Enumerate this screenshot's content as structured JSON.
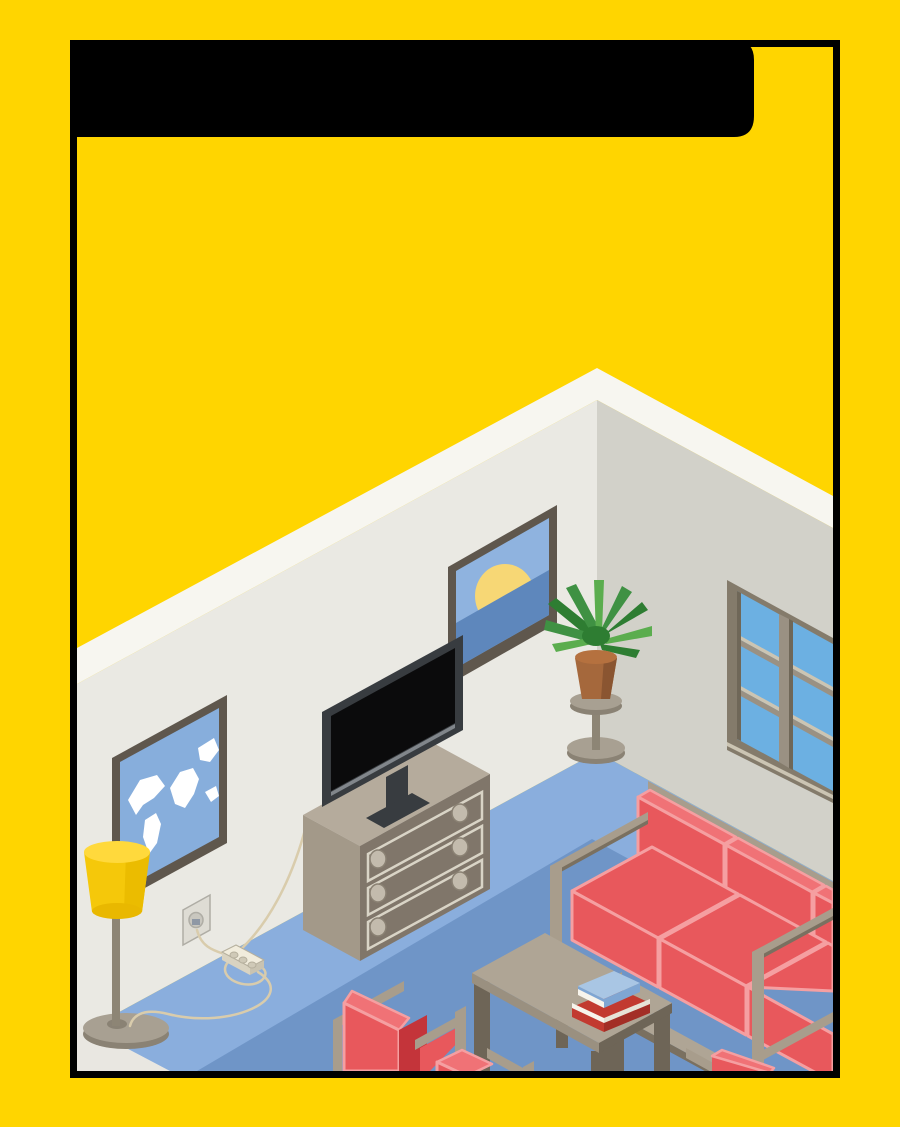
{
  "scene": {
    "description": "Isometric living-room illustration inside a black rectangular frame on a yellow poster; blank black rounded banner at top",
    "objects": [
      "title-banner",
      "poster-frame",
      "room-corner-walls",
      "blue-carpet",
      "dark-blue-rug",
      "world-map-picture",
      "sunset-picture",
      "window",
      "tv",
      "drawer-dresser",
      "floor-lamp",
      "plant-stand",
      "potted-plant",
      "wall-outlet",
      "power-strip",
      "cables",
      "sofa",
      "coffee-table",
      "book-stack",
      "armchairs"
    ]
  },
  "colors": {
    "yellow": "#FFD500",
    "black": "#000000",
    "band": "#F7F6F0",
    "wall_left": "#EAE9E3",
    "wall_right": "#D2D1C9",
    "floor_gray": "#E9E7E1",
    "carpet_light": "#8AAEDD",
    "rug_dark": "#6F95C7",
    "frame_dark": "#5F574D",
    "pic_sky": "#8FB3DF",
    "pic_sea": "#5E87BC",
    "sun": "#F7D775",
    "map_blue": "#87AEDC",
    "white": "#FFFFFF",
    "pane": "#6CB0E2",
    "sill": "#CCC5B3",
    "win_frame": "#847B6B",
    "mullion": "#9A9183",
    "win_dark": "#6F6758",
    "dresser_top": "#B5AB9C",
    "dresser_side": "#A39989",
    "dresser_front": "#80766A",
    "cream_line": "#D9D4C6",
    "knob": "#C3BBAD",
    "knob_edge": "#8A8173",
    "tv_frame": "#383C40",
    "tv_screen": "#0B0B0C",
    "tv_strip": "#81868B",
    "red": "#E8585C",
    "red_light": "#F07276",
    "red_outline": "#F59FA1",
    "red_dark": "#C4343A",
    "red_deep": "#A82A30",
    "taupe_light": "#AFA595",
    "taupe_mid": "#9A9080",
    "taupe_dark": "#6E6557",
    "rail": "#A89D8C",
    "rail_dark": "#7A7060",
    "lamp_yellow": "#F5C80A",
    "lamp_top": "#FFD93C",
    "lamp_shadow": "#EBBC00",
    "lamp_rim": "#E9B800",
    "pole": "#8D8575",
    "gray_base": "#A8A092",
    "gray_base_dark": "#8A8274",
    "pot": "#A5683C",
    "pot_dark": "#8A5531",
    "pot_rim": "#B5713F",
    "leaf_dark": "#2E7D32",
    "leaf_mid": "#3F9143",
    "leaf_light": "#5BAD4E",
    "outlet": "#DEDCD4",
    "outlet_inner": "#C9C7BF",
    "outlet_edge": "#AFADA5",
    "plug": "#8F98A5",
    "strip_top": "#F1ECDC",
    "strip_side": "#D9D3C1",
    "strip_end": "#C9C3B1",
    "strip_hole": "#CFC9B7",
    "strip_edge": "#B5AF9D",
    "cable": "#D9CCAC",
    "book_red": "#C23A30",
    "book_red_dark": "#A32E26",
    "book_blue": "#7FA6D3",
    "book_blue_top": "#A9C6E4",
    "pages": "#F7F4EC",
    "pages_dark": "#E6E2D6"
  }
}
